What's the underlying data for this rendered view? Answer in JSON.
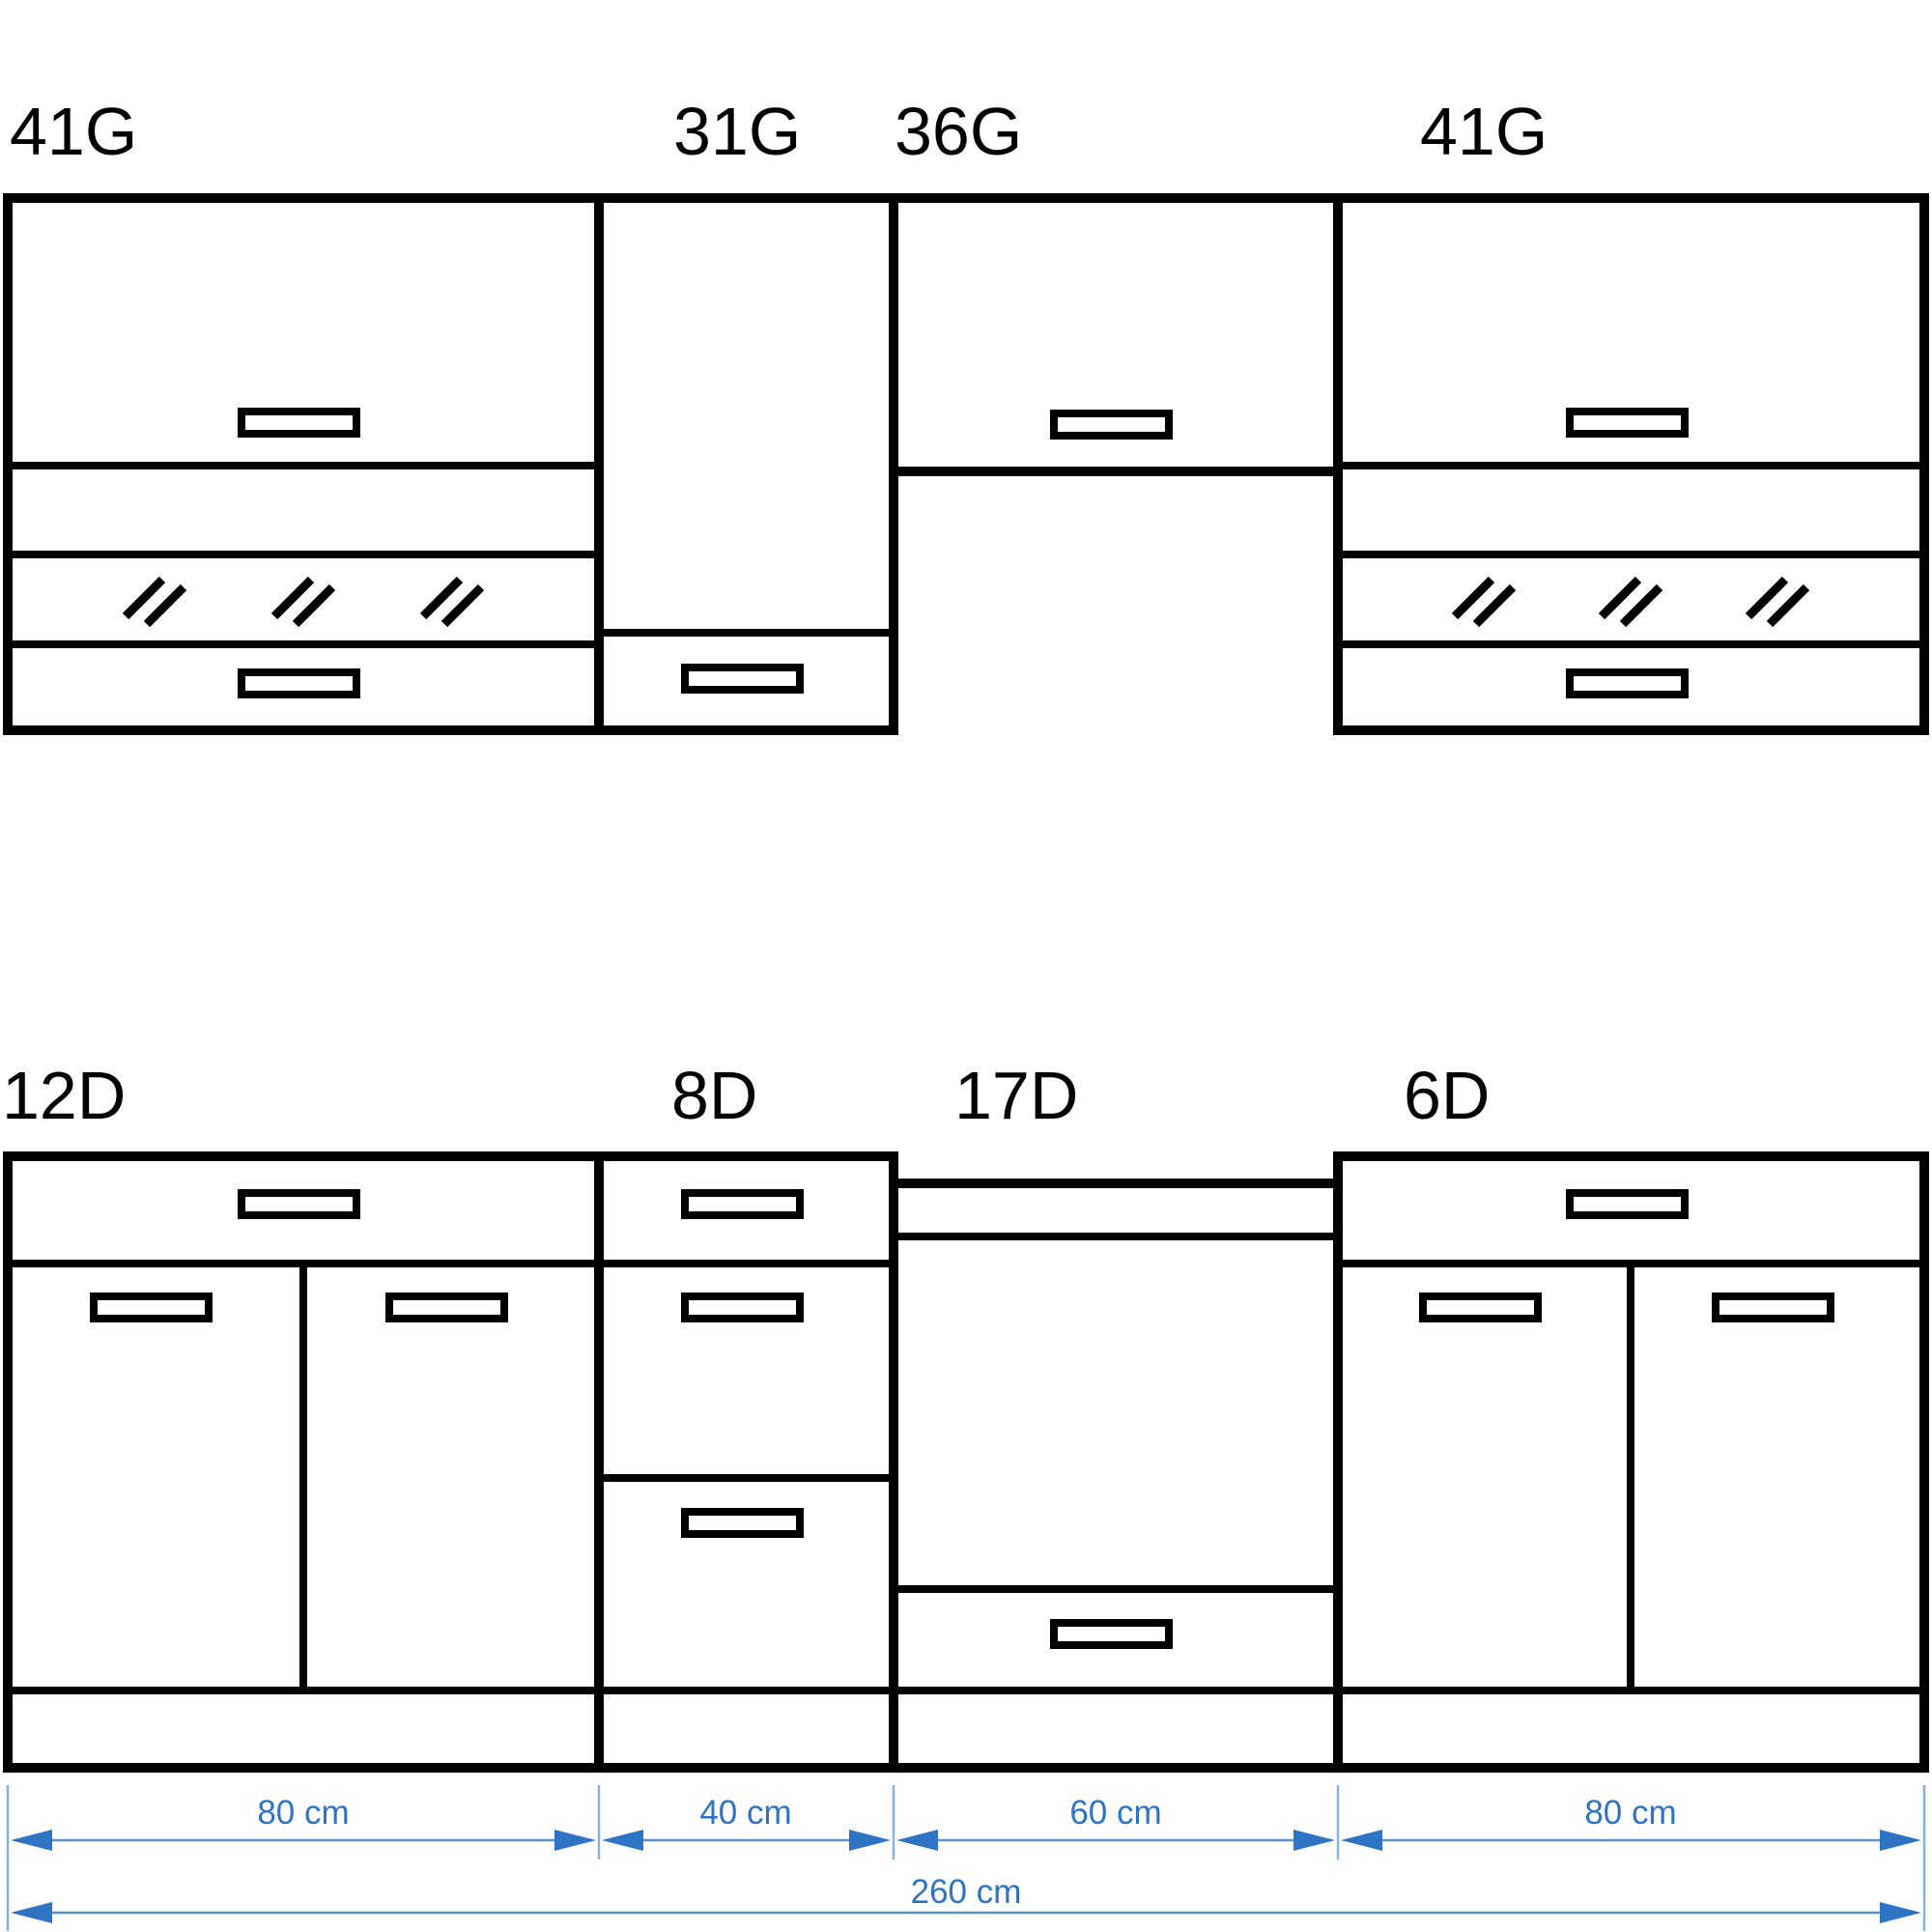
{
  "wall_units": [
    {
      "id": "41G",
      "width_cm": 80
    },
    {
      "id": "31G",
      "width_cm": 40
    },
    {
      "id": "36G",
      "width_cm": 60
    },
    {
      "id": "41G",
      "width_cm": 80
    }
  ],
  "base_units": [
    {
      "id": "12D",
      "width_cm": 80
    },
    {
      "id": "8D",
      "width_cm": 40
    },
    {
      "id": "17D",
      "width_cm": 60
    },
    {
      "id": "6D",
      "width_cm": 80
    }
  ],
  "dimensions": {
    "segments": [
      {
        "label": "80 cm",
        "cm": 80
      },
      {
        "label": "40 cm",
        "cm": 40
      },
      {
        "label": "60 cm",
        "cm": 60
      },
      {
        "label": "80 cm",
        "cm": 80
      }
    ],
    "total": {
      "label": "260 cm",
      "cm": 260
    }
  },
  "colors": {
    "outline": "#000000",
    "dimension_blue": "#2e74c4",
    "background": "#ffffff"
  }
}
